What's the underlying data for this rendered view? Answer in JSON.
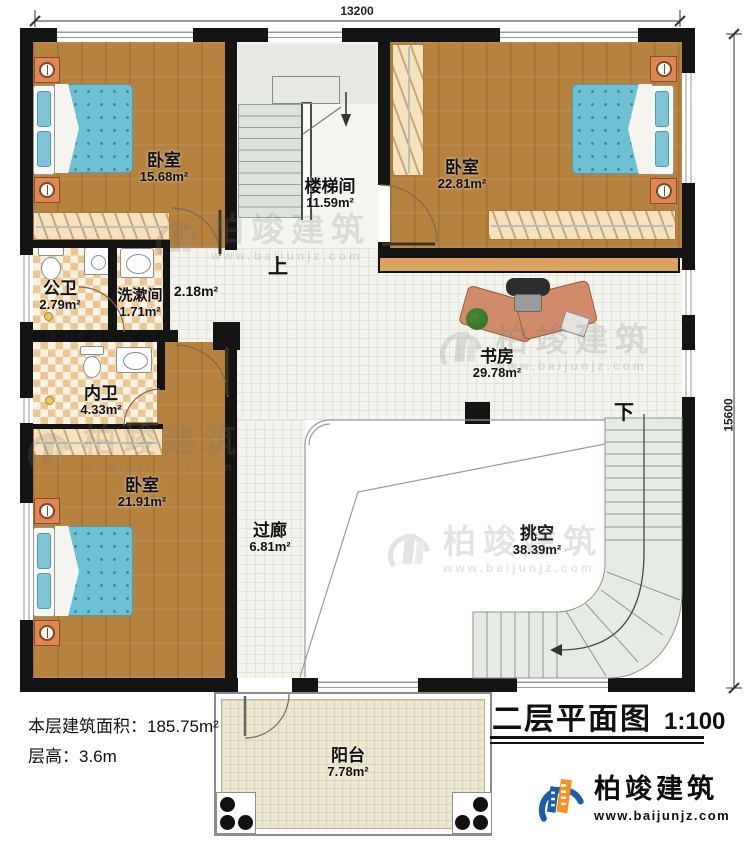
{
  "title_block": {
    "title": "二层平面图",
    "scale": "1:100"
  },
  "dimensions": {
    "width": "13200",
    "height": "15600"
  },
  "info": [
    {
      "label": "本层建筑面积：",
      "value": "185.75m²"
    },
    {
      "label": "层高：",
      "value": "3.6m"
    }
  ],
  "rooms": {
    "bedroom_tl": {
      "name": "卧室",
      "area": "15.68m²"
    },
    "stairwell": {
      "name": "楼梯间",
      "area": "11.59m²"
    },
    "bedroom_tr": {
      "name": "卧室",
      "area": "22.81m²"
    },
    "public_bath": {
      "name": "公卫",
      "area": "2.79m²"
    },
    "washroom": {
      "name": "洗漱间",
      "area": "1.71m²"
    },
    "vestibule": {
      "area": "2.18m²"
    },
    "study": {
      "name": "书房",
      "area": "29.78m²"
    },
    "private_bath": {
      "name": "内卫",
      "area": "4.33m²"
    },
    "bedroom_bl": {
      "name": "卧室",
      "area": "21.91m²"
    },
    "corridor": {
      "name": "过廊",
      "area": "6.81m²"
    },
    "void": {
      "name": "挑空",
      "area": "38.39m²"
    },
    "balcony": {
      "name": "阳台",
      "area": "7.78m²"
    }
  },
  "stairs": {
    "up_label": "上",
    "down_label": "下"
  },
  "brand": {
    "name": "柏竣建筑",
    "url": "www.baijunjz.com"
  },
  "watermark": {
    "name": "柏竣建筑",
    "url": "www.baijunjz.com"
  },
  "colors": {
    "wall": "#141414",
    "wood": "#b5823f",
    "bed_blue": "#6ec0d3",
    "bath_tile": "#ecc795",
    "logo_blue": "#1a5fa8",
    "logo_orange": "#f6921e"
  }
}
